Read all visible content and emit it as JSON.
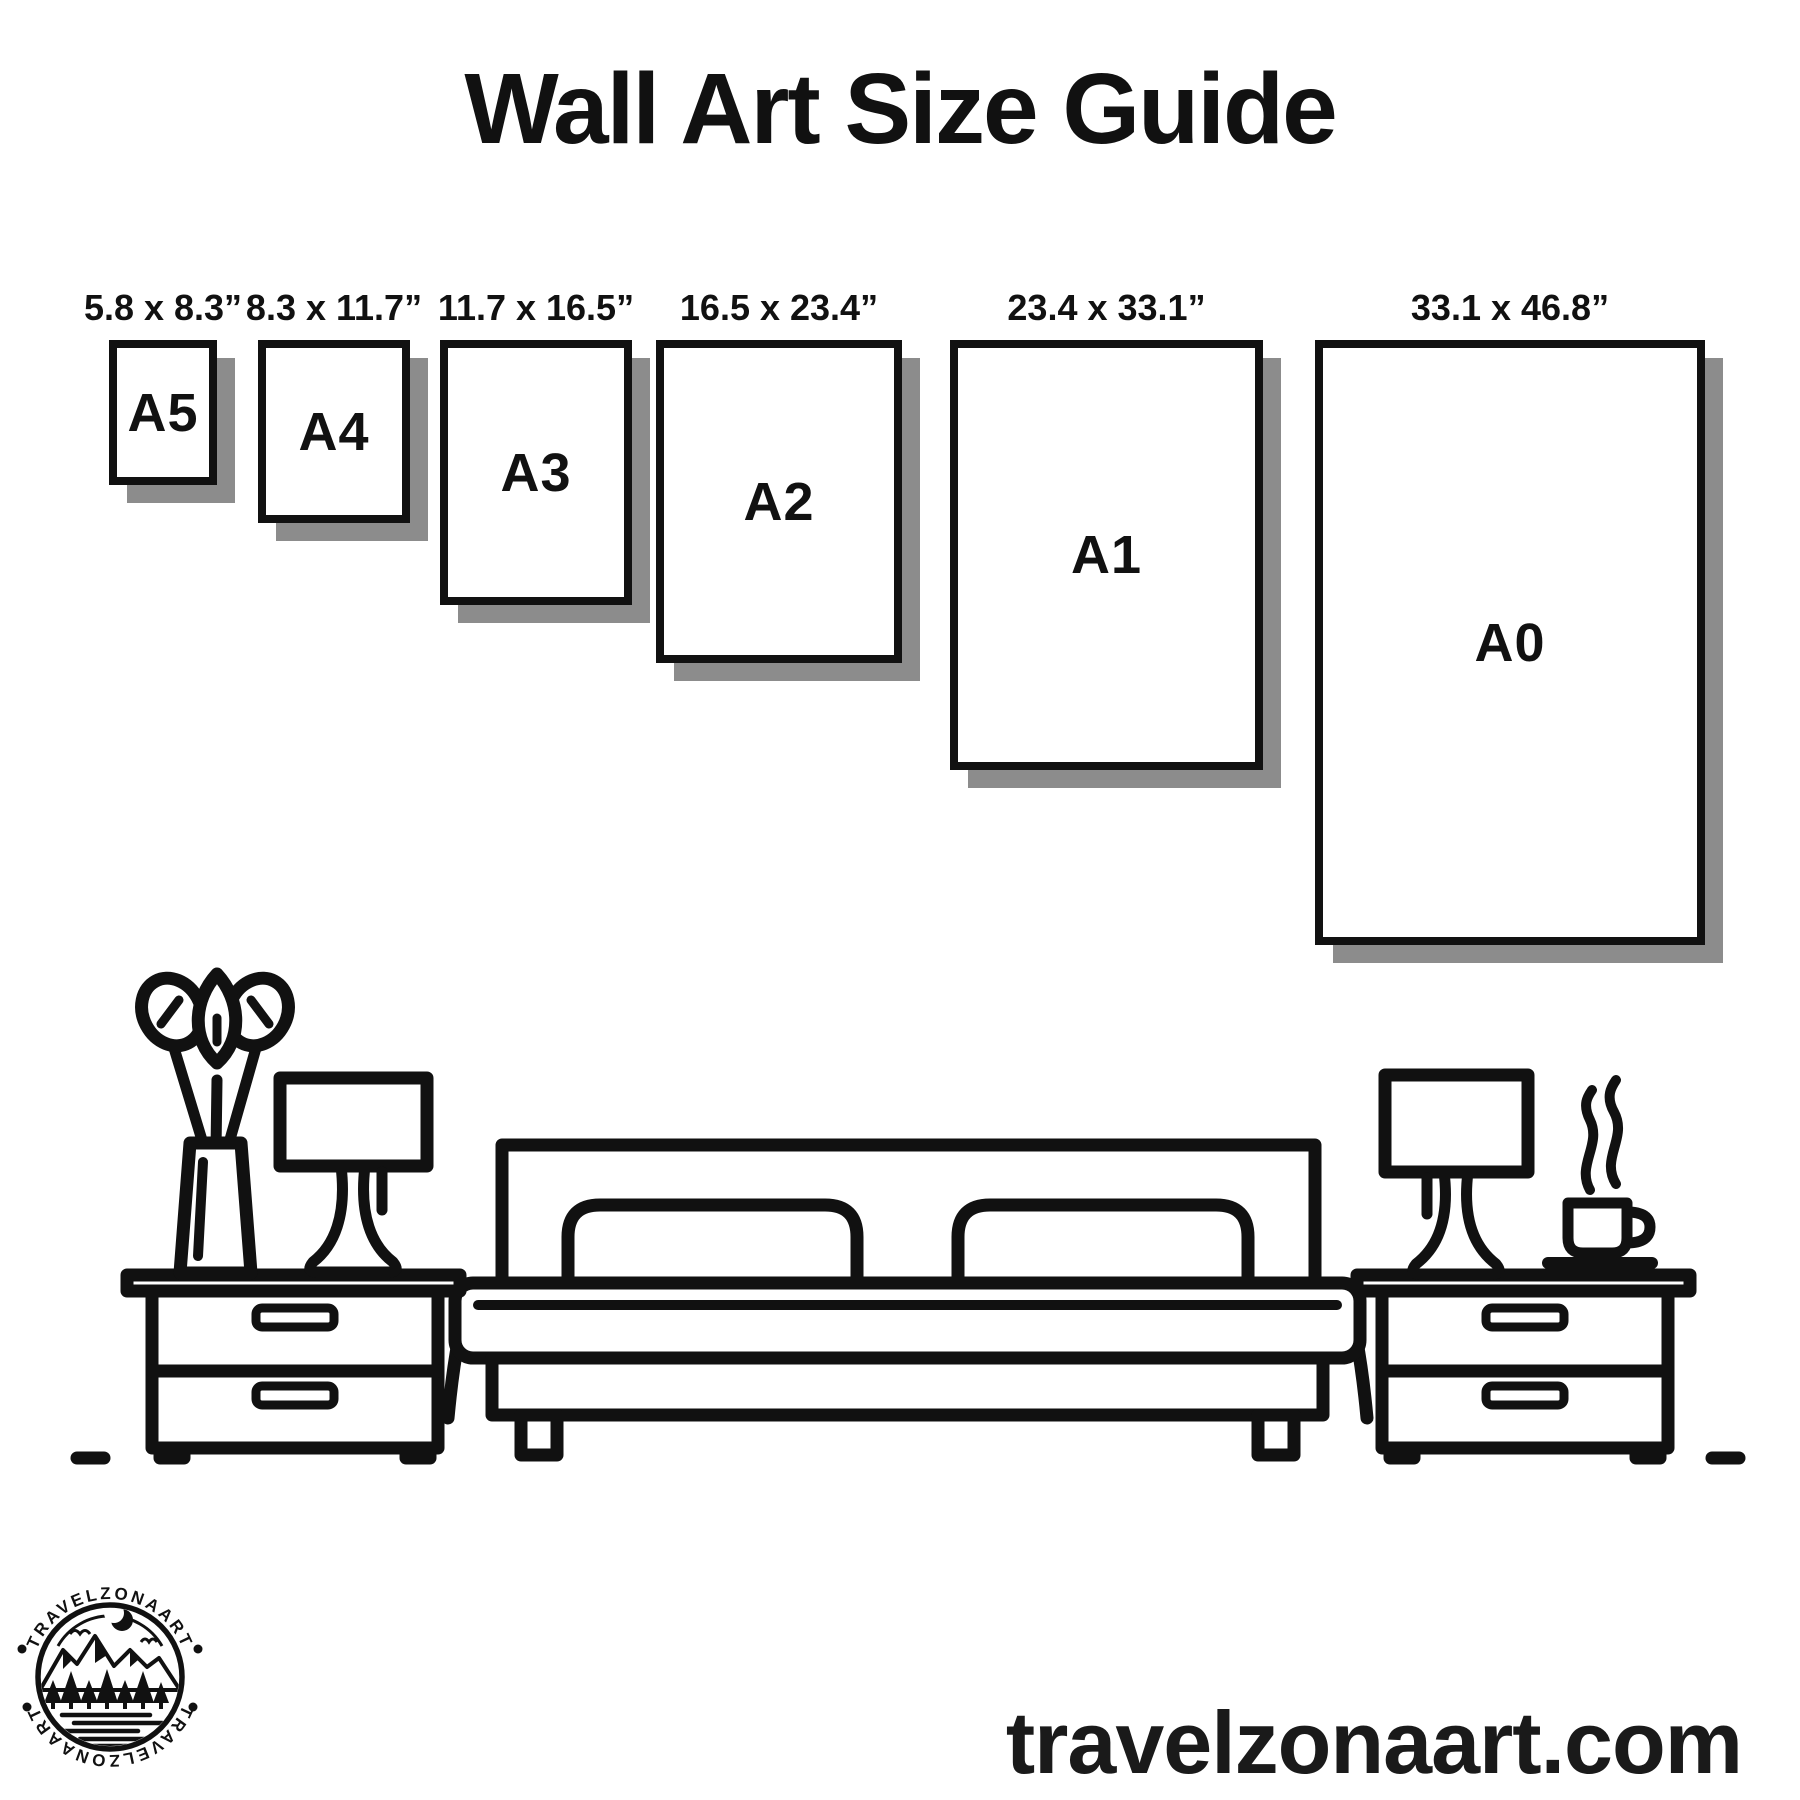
{
  "title": "Wall Art Size Guide",
  "sizes": [
    {
      "label": "A5",
      "dimensions": "5.8 x 8.3”"
    },
    {
      "label": "A4",
      "dimensions": "8.3 x 11.7”"
    },
    {
      "label": "A3",
      "dimensions": "11.7 x 16.5”"
    },
    {
      "label": "A2",
      "dimensions": "16.5 x 23.4”"
    },
    {
      "label": "A1",
      "dimensions": "23.4 x 33.1”"
    },
    {
      "label": "A0",
      "dimensions": "33.1 x 46.8”"
    }
  ],
  "scene_icons": [
    "vase-plant-icon",
    "table-lamp-icon",
    "nightstand-icon",
    "bed-icon",
    "coffee-cup-icon",
    "floor-line"
  ],
  "logo": {
    "arc_text_top": "TRAVELZONAART",
    "arc_text_bottom": "TRAVELZONAART"
  },
  "footer": {
    "website": "travelzonaart.com"
  },
  "colors": {
    "ink": "#111111",
    "shadow": "#8c8c8c",
    "background": "#ffffff"
  }
}
